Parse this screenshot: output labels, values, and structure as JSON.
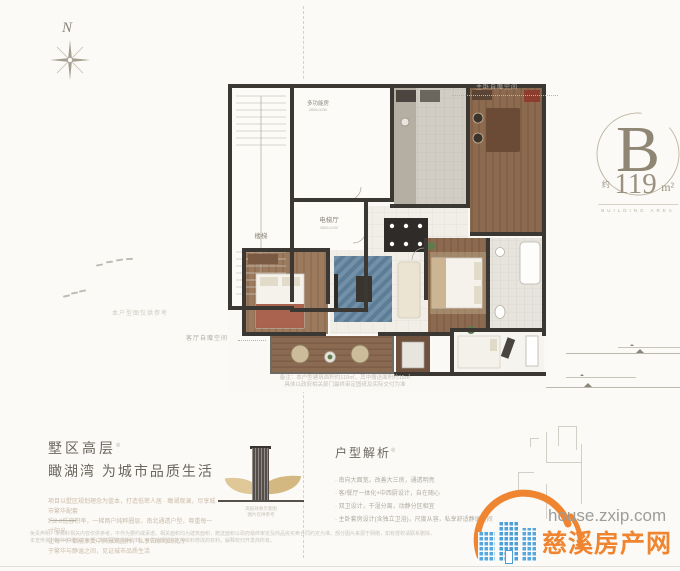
{
  "compass": {
    "label": "N"
  },
  "unit_badge": {
    "letter": "B",
    "area_prefix": "约",
    "area_value": "119",
    "area_unit": "m²",
    "caption": "BUILDING AREA"
  },
  "floorplan": {
    "labels": {
      "stairs": "楼梯",
      "elevator_hall": "电梯厅",
      "elevator_dims": "2600×2100",
      "multi_room": "多功能房",
      "multi_room_dims": "2800×3150"
    },
    "annotations": {
      "gift_top": "主卧自赠空间",
      "gift_left": "客厅自赠空间",
      "reference": "本户型图仅供参考",
      "note_line1": "备注：本户型建筑面积约119㎡，其中赠送面积约15㎡",
      "note_line2": "具体以政府相关部门最终审定图纸及实际交付为准"
    }
  },
  "left_section": {
    "title_line1": "墅区高层",
    "title_sup": "◎",
    "title_line2": "瞰湖湾 为城市品质生活",
    "paragraph_lines": [
      "项目以墅区规划理念为蓝本，打造低密人居 · 瞰湖观澜，尽享城市繁华配套",
      "约2.0低容积率，一梯两户纯粹圈层，南北通透户型，尊重每一寸阳光",
      "让每一户都能享受中央景观园林，私享归家动线礼序",
      "于繁华与静谧之间，见证城市品质生活"
    ]
  },
  "tower_illustration": {
    "caption_line1": "高层效果示意图",
    "caption_line2": "图片仅供参考"
  },
  "right_section": {
    "title": "户型解析",
    "title_sup": "◎",
    "bullets": [
      "· 南向大面宽，改善大三房，通透明亮",
      "· 客/餐厅一体化+中西厨设计，自在随心",
      "· 双卫设计，干湿分离，动静分区相宜",
      "· 主卧套房设计(含独立卫浴)，尺度从容，私享舒适静谧空间"
    ]
  },
  "fine_print": {
    "lines": [
      "免责声明：本资料相关内容仅供参考，不作为要约或承诺。相关面积均为建筑面积，赠送面积以政府最终审定及商品房买卖合同约定为准，部分图片来源于网络，如有侵权请联系删除。",
      "本宣传资料制作时间为本年度，敬请留意最新资料。开发商保留对宣传资料修改的权利，解释权归开发商所有。"
    ]
  },
  "watermark": {
    "url": "house.zxip.com",
    "site_name": "慈溪房产网"
  },
  "colors": {
    "accent_orange": "#ef8530",
    "brand_blue": "#58a7dc",
    "wall": "#3b3733",
    "gold": "#c9ad77"
  }
}
